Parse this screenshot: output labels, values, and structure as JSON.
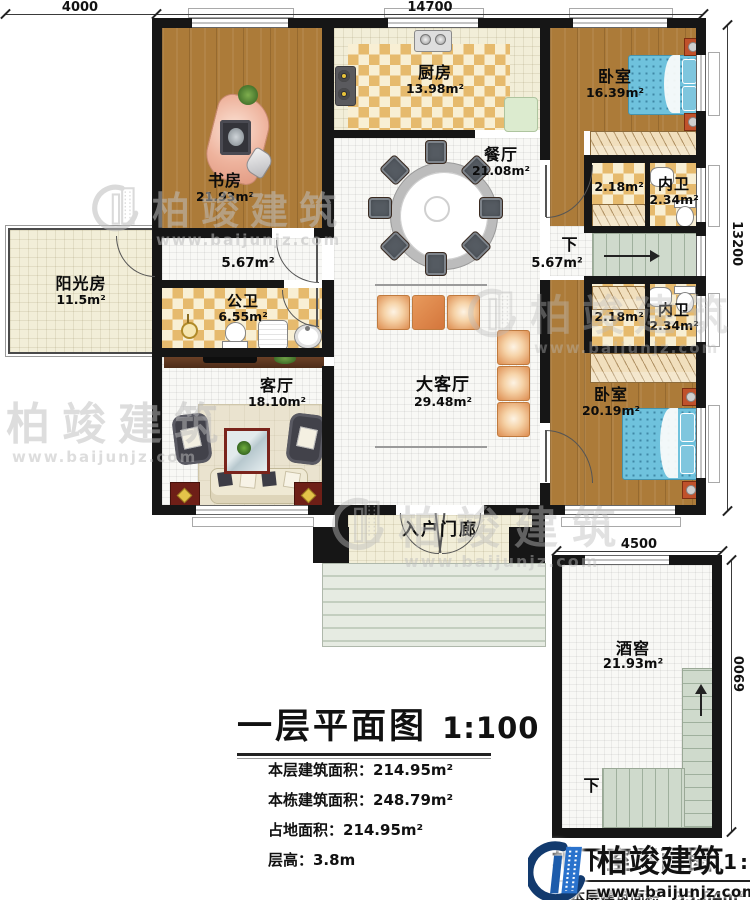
{
  "watermark": {
    "brand": "柏竣建筑",
    "url": "www.baijunjz.com"
  },
  "dims": {
    "d4000": "4000",
    "d14700": "14700",
    "d13200": "13200",
    "d4500": "4500",
    "d6900": "6900"
  },
  "rooms": {
    "study": {
      "name": "书房",
      "area": "21.93m²"
    },
    "kitchen": {
      "name": "厨房",
      "area": "13.98m²"
    },
    "bedroom1": {
      "name": "卧室",
      "area": "16.39m²"
    },
    "dining": {
      "name": "餐厅",
      "area": "21.08m²"
    },
    "closet1": {
      "area": "2.18m²"
    },
    "bath1": {
      "name": "内卫",
      "area": "2.34m²"
    },
    "sunroom": {
      "name": "阳光房",
      "area": "11.5m²"
    },
    "hall": {
      "area": "5.67m²"
    },
    "stairs": {
      "label": "下",
      "area": "5.67m²"
    },
    "pubbath": {
      "name": "公卫",
      "area": "6.55m²"
    },
    "living": {
      "name": "客厅",
      "area": "18.10m²"
    },
    "greathall": {
      "name": "大客厅",
      "area": "29.48m²"
    },
    "closet2": {
      "area": "2.18m²"
    },
    "bath2": {
      "name": "内卫",
      "area": "2.34m²"
    },
    "bedroom2": {
      "name": "卧室",
      "area": "20.19m²"
    },
    "porch": {
      "name": "入户门廊"
    },
    "cellar": {
      "name": "酒窖",
      "area": "21.93m²",
      "down": "下"
    }
  },
  "title_block": {
    "title": "一层平面图",
    "scale": "1:100",
    "info": [
      "本层建筑面积：214.95m²",
      "本栋建筑面积：248.79m²",
      "占地面积：214.95m²",
      "层高：3.8m"
    ]
  },
  "basement_block": {
    "title": "地下室平面图",
    "scale": "1:100",
    "info": "本层建筑面积：33.84m²"
  }
}
